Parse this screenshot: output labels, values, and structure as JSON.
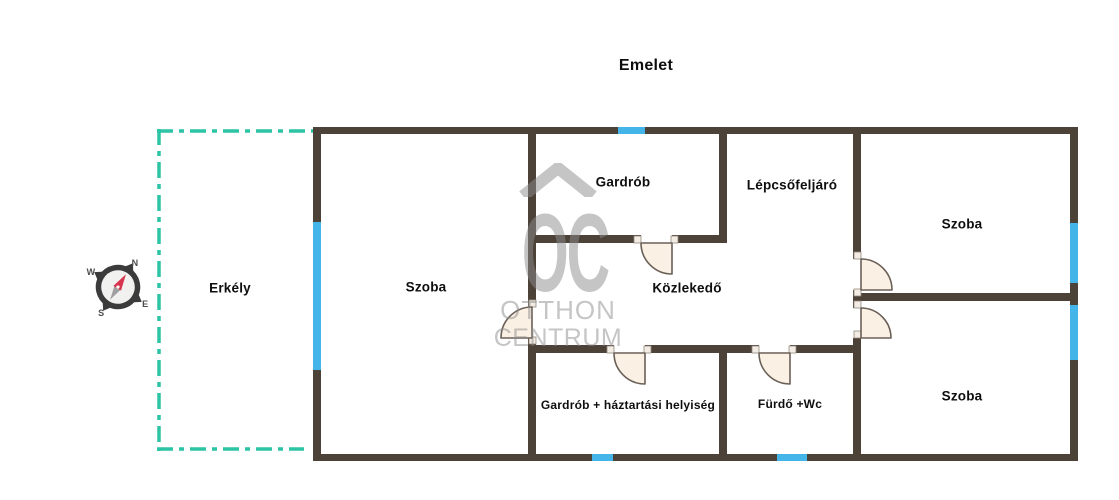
{
  "page_title": "Emelet",
  "floor_plan": {
    "rooms": {
      "erkely": "Erkély",
      "szoba_left": "Szoba",
      "gardrob": "Gardrób",
      "lepcsofeljaro": "Lépcsőfeljáró",
      "kozlekedo": "Közlekedő",
      "szoba_top_right": "Szoba",
      "szoba_bottom_right": "Szoba",
      "gardrob_haztartasi": "Gardrób + háztartási helyiség",
      "furdo_wc": "Fürdő +Wc"
    },
    "colors": {
      "wall": "#4d4238",
      "window": "#44b5e9",
      "balcony_outline": "#2bc4a4",
      "door_fill": "#faf0e3",
      "compass_needle_red": "#d6354d"
    }
  },
  "compass": {
    "north": "N",
    "west": "W",
    "south": "S",
    "east": "E"
  },
  "watermark": {
    "monogram": "OC",
    "line1": "OTTHON",
    "line2": "CENTRUM"
  }
}
